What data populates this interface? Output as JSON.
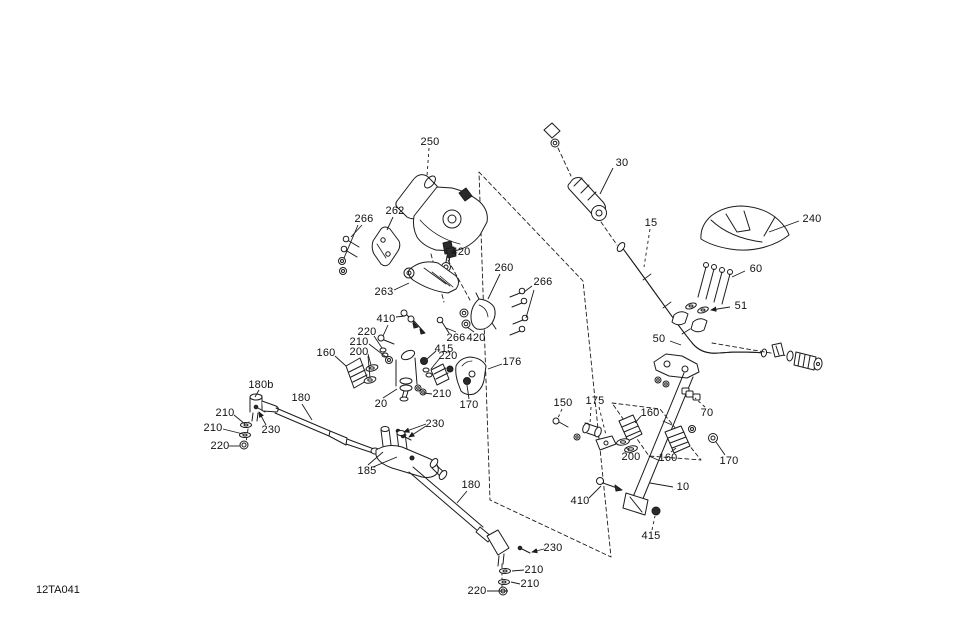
{
  "diagram": {
    "code": "12TA041",
    "background": "#ffffff",
    "line_color": "#1c1c1c",
    "label_color": "#111111",
    "labels": [
      {
        "text": "250",
        "x": 430,
        "y": 142,
        "dashed": true,
        "leaders": [
          [
            429,
            148,
            427,
            176
          ]
        ]
      },
      {
        "text": "30",
        "x": 622,
        "y": 163,
        "leaders": [
          [
            613,
            168,
            600,
            194
          ]
        ]
      },
      {
        "text": "240",
        "x": 812,
        "y": 219,
        "leaders": [
          [
            799,
            221,
            769,
            232
          ]
        ]
      },
      {
        "text": "15",
        "x": 651,
        "y": 223,
        "dashed": true,
        "leaders": [
          [
            650,
            229,
            644,
            267
          ]
        ]
      },
      {
        "text": "60",
        "x": 756,
        "y": 269,
        "leaders": [
          [
            745,
            271,
            732,
            277
          ]
        ]
      },
      {
        "text": "51",
        "x": 741,
        "y": 306,
        "arrow": true,
        "leaders": [
          [
            730,
            307,
            711,
            310
          ]
        ]
      },
      {
        "text": "50",
        "x": 659,
        "y": 339,
        "leaders": [
          [
            670,
            341,
            681,
            345
          ]
        ]
      },
      {
        "text": "266",
        "x": 364,
        "y": 219,
        "leaders": [
          [
            362,
            225,
            351,
            237
          ],
          [
            358,
            225,
            344,
            258
          ]
        ]
      },
      {
        "text": "262",
        "x": 395,
        "y": 211,
        "leaders": [
          [
            393,
            217,
            387,
            230
          ]
        ]
      },
      {
        "text": "420",
        "x": 461,
        "y": 252,
        "leaders": [
          [
            456,
            253,
            453,
            253
          ]
        ]
      },
      {
        "text": "260",
        "x": 504,
        "y": 268,
        "leaders": [
          [
            500,
            274,
            488,
            299
          ]
        ]
      },
      {
        "text": "266",
        "x": 543,
        "y": 282,
        "leaders": [
          [
            532,
            286,
            524,
            292
          ],
          [
            534,
            290,
            526,
            318
          ]
        ]
      },
      {
        "text": "263",
        "x": 384,
        "y": 292,
        "leaders": [
          [
            394,
            290,
            409,
            283
          ]
        ]
      },
      {
        "text": "266",
        "x": 456,
        "y": 338,
        "leaders": [
          [
            456,
            332,
            446,
            328
          ]
        ]
      },
      {
        "text": "420",
        "x": 476,
        "y": 338,
        "leaders": [
          [
            474,
            332,
            467,
            327
          ]
        ]
      },
      {
        "text": "410",
        "x": 386,
        "y": 319,
        "leaders": [
          [
            396,
            317,
            405,
            316
          ],
          [
            388,
            325,
            383,
            336
          ]
        ]
      },
      {
        "text": "220",
        "x": 367,
        "y": 332,
        "leaders": [
          [
            374,
            336,
            382,
            348
          ]
        ]
      },
      {
        "text": "210",
        "x": 359,
        "y": 342,
        "leaders": [
          [
            369,
            344,
            386,
            357
          ]
        ]
      },
      {
        "text": "200",
        "x": 359,
        "y": 352,
        "leaders": [
          [
            368,
            354,
            371,
            365
          ],
          [
            368,
            356,
            370,
            378
          ]
        ]
      },
      {
        "text": "160",
        "x": 326,
        "y": 353,
        "leaders": [
          [
            335,
            356,
            346,
            366
          ]
        ]
      },
      {
        "text": "415",
        "x": 444,
        "y": 349,
        "leaders": [
          [
            436,
            351,
            427,
            359
          ]
        ]
      },
      {
        "text": "220",
        "x": 448,
        "y": 356,
        "leaders": [
          [
            440,
            358,
            431,
            369
          ]
        ]
      },
      {
        "text": "176",
        "x": 512,
        "y": 362,
        "leaders": [
          [
            502,
            364,
            488,
            369
          ]
        ]
      },
      {
        "text": "210",
        "x": 442,
        "y": 394,
        "leaders": [
          [
            432,
            394,
            424,
            393
          ]
        ]
      },
      {
        "text": "20",
        "x": 381,
        "y": 404,
        "leaders": [
          [
            383,
            398,
            397,
            389
          ]
        ]
      },
      {
        "text": "170",
        "x": 469,
        "y": 405,
        "leaders": [
          [
            469,
            399,
            467,
            385
          ]
        ]
      },
      {
        "text": "230",
        "x": 435,
        "y": 424,
        "arrow": true,
        "leaders": [
          [
            426,
            424,
            404,
            432
          ],
          [
            426,
            426,
            409,
            437
          ]
        ]
      },
      {
        "text": "180b",
        "x": 261,
        "y": 385,
        "leaders": [
          [
            259,
            390,
            255,
            397
          ]
        ]
      },
      {
        "text": "180",
        "x": 301,
        "y": 398,
        "leaders": [
          [
            302,
            404,
            312,
            420
          ]
        ]
      },
      {
        "text": "210",
        "x": 225,
        "y": 413,
        "leaders": [
          [
            234,
            415,
            245,
            424
          ]
        ]
      },
      {
        "text": "210",
        "x": 213,
        "y": 428,
        "leaders": [
          [
            223,
            429,
            243,
            434
          ]
        ]
      },
      {
        "text": "220",
        "x": 220,
        "y": 446,
        "leaders": [
          [
            229,
            446,
            240,
            446
          ]
        ]
      },
      {
        "text": "230",
        "x": 271,
        "y": 430,
        "arrow": true,
        "leaders": [
          [
            266,
            425,
            259,
            412
          ]
        ]
      },
      {
        "text": "185",
        "x": 367,
        "y": 471,
        "leaders": [
          [
            368,
            465,
            383,
            452
          ],
          [
            373,
            467,
            397,
            457
          ]
        ]
      },
      {
        "text": "180",
        "x": 471,
        "y": 485,
        "leaders": [
          [
            467,
            491,
            457,
            503
          ]
        ]
      },
      {
        "text": "230",
        "x": 553,
        "y": 548,
        "arrow": true,
        "leaders": [
          [
            544,
            549,
            532,
            552
          ]
        ]
      },
      {
        "text": "210",
        "x": 534,
        "y": 570,
        "leaders": [
          [
            524,
            570,
            512,
            571
          ]
        ]
      },
      {
        "text": "210",
        "x": 530,
        "y": 584,
        "leaders": [
          [
            520,
            584,
            511,
            582
          ]
        ]
      },
      {
        "text": "220",
        "x": 477,
        "y": 591,
        "leaders": [
          [
            487,
            591,
            508,
            591
          ]
        ]
      },
      {
        "text": "150",
        "x": 563,
        "y": 403,
        "dashed": true,
        "leaders": [
          [
            562,
            409,
            558,
            418
          ]
        ]
      },
      {
        "text": "175",
        "x": 595,
        "y": 401,
        "dashed": true,
        "leaders": [
          [
            591,
            407,
            590,
            424
          ],
          [
            599,
            407,
            606,
            435
          ]
        ]
      },
      {
        "text": "160",
        "x": 650,
        "y": 413,
        "leaders": [
          [
            641,
            416,
            635,
            423
          ]
        ]
      },
      {
        "text": "70",
        "x": 707,
        "y": 413,
        "dashed": true,
        "leaders": [
          [
            705,
            407,
            695,
            398
          ]
        ]
      },
      {
        "text": "200",
        "x": 631,
        "y": 457,
        "leaders": [
          [
            629,
            451,
            626,
            447
          ]
        ]
      },
      {
        "text": "160",
        "x": 668,
        "y": 458,
        "leaders": [
          [
            671,
            452,
            676,
            448
          ]
        ]
      },
      {
        "text": "170",
        "x": 729,
        "y": 461,
        "leaders": [
          [
            725,
            455,
            716,
            442
          ]
        ]
      },
      {
        "text": "410",
        "x": 580,
        "y": 501,
        "leaders": [
          [
            589,
            498,
            601,
            486
          ]
        ]
      },
      {
        "text": "10",
        "x": 683,
        "y": 487,
        "leaders": [
          [
            673,
            487,
            650,
            483
          ]
        ]
      },
      {
        "text": "415",
        "x": 651,
        "y": 536,
        "dashed": true,
        "leaders": [
          [
            652,
            530,
            655,
            516
          ]
        ]
      }
    ]
  }
}
